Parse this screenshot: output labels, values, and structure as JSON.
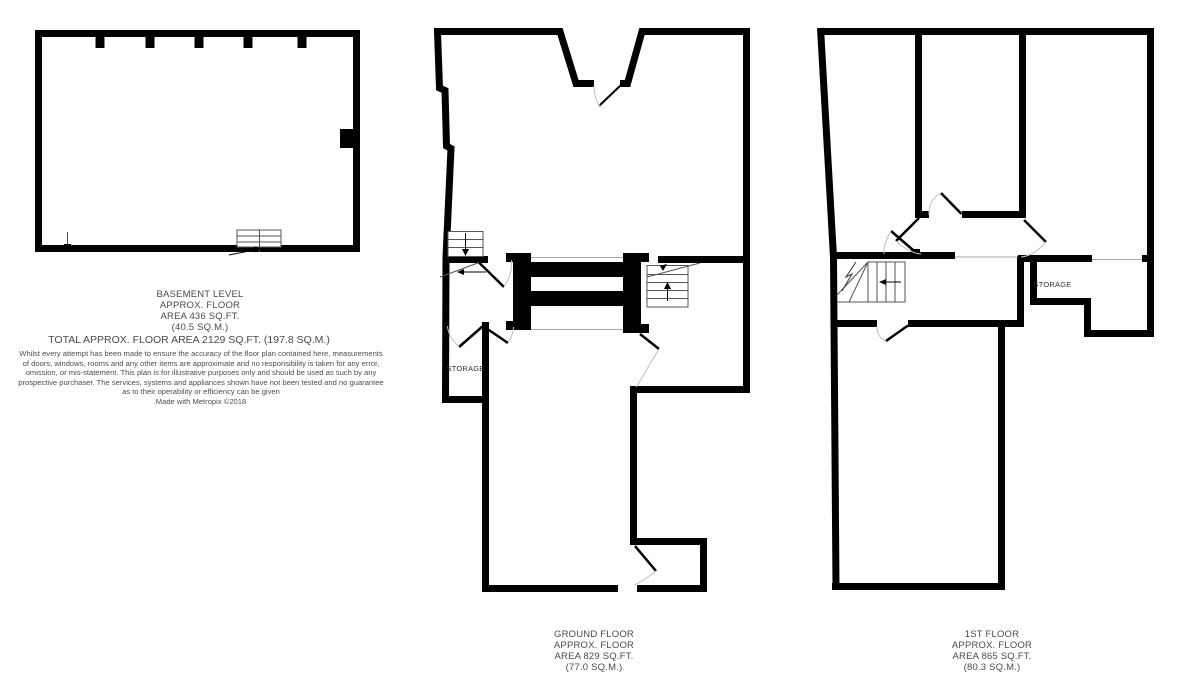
{
  "floors": {
    "basement": {
      "name_lines": [
        "BASEMENT LEVEL",
        "APPROX. FLOOR",
        "AREA 436 SQ.FT.",
        "(40.5 SQ.M.)"
      ]
    },
    "ground": {
      "name_lines": [
        "GROUND FLOOR",
        "APPROX. FLOOR",
        "AREA 829 SQ.FT.",
        "(77.0 SQ.M.)"
      ],
      "storage_label": "STORAGE"
    },
    "first": {
      "name_lines": [
        "1ST FLOOR",
        "APPROX. FLOOR",
        "AREA 865 SQ.FT.",
        "(80.3 SQ.M.)"
      ],
      "storage_label": "STORAGE"
    }
  },
  "total_area_line": "TOTAL APPROX. FLOOR AREA 2129 SQ.FT. (197.8 SQ.M.)",
  "disclaimer_lines": [
    "Whilst every attempt has been made to ensure the accuracy of the floor plan contained here, measurements",
    "of doors, windows, rooms and any other items are approximate and no responsibility is taken for any error,",
    "omission, or mis-statement. This plan is for illustrative purposes only and should be used as such by any",
    "prospective purchaser. The services, systems and appliances shown have not been tested and no guarantee",
    "as to their operability or efficiency can be given",
    "Made with Metropix ©2018"
  ],
  "colors": {
    "wall": "#000000",
    "detail_line": "#555555",
    "door_arc": "#bfbfbf",
    "text": "#4a4a4a"
  }
}
